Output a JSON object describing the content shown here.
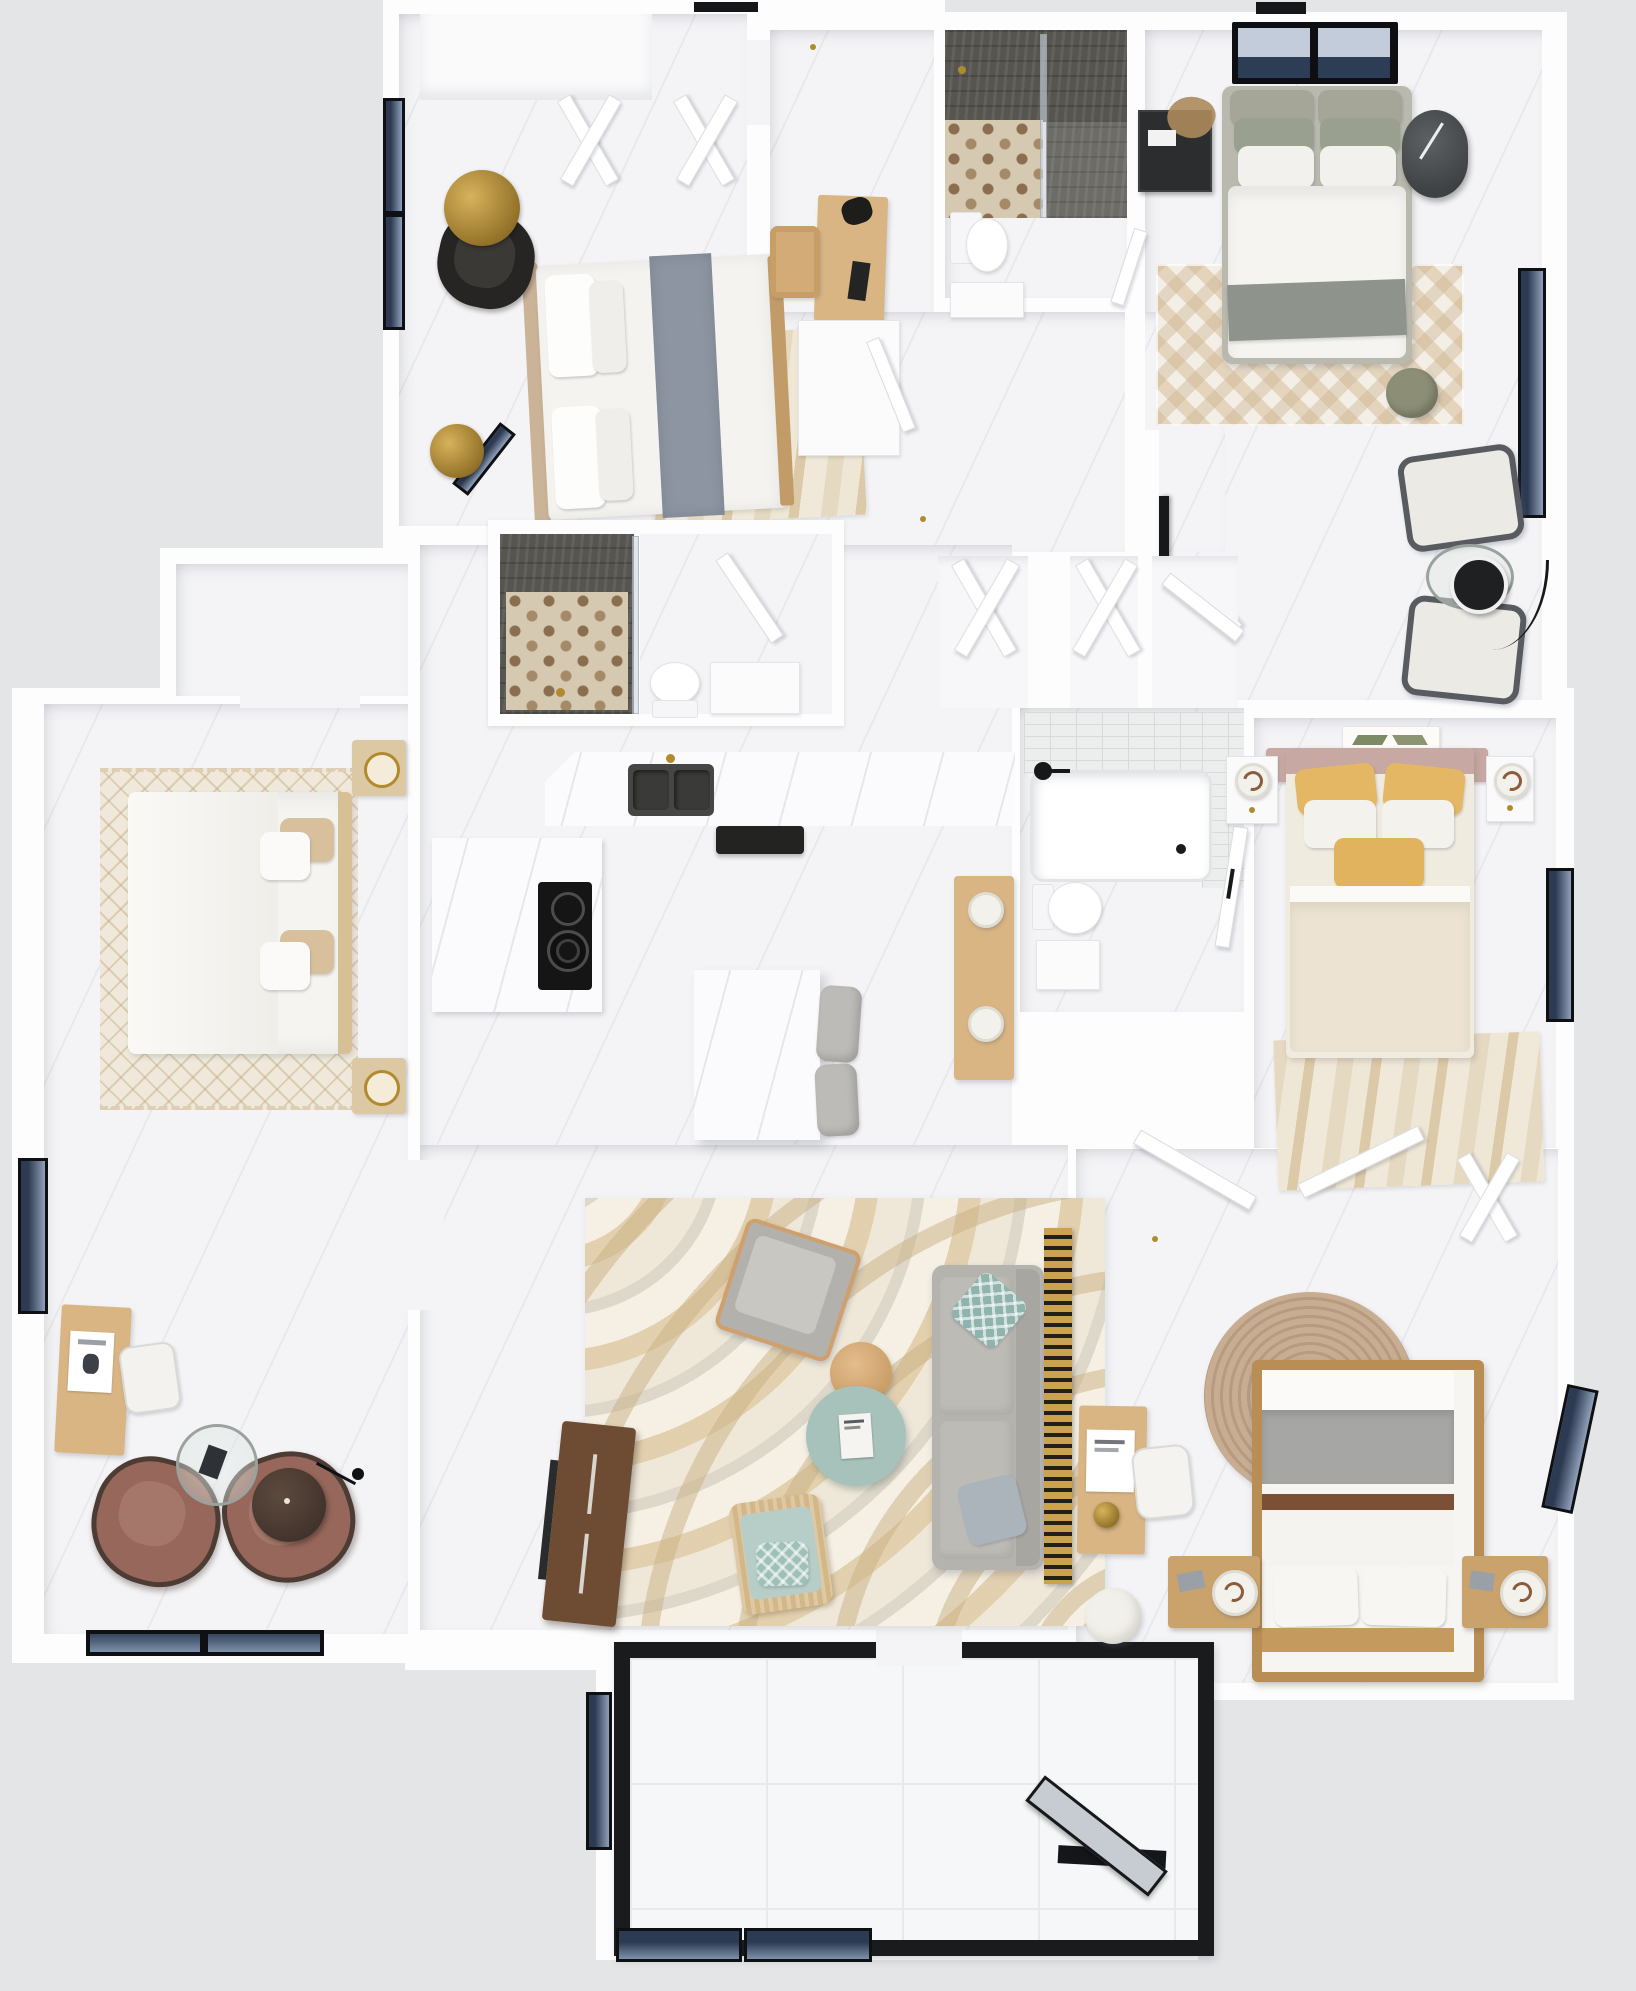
{
  "scene": {
    "title": "3D top-down floor plan rendering of a four-bedroom home",
    "view": "overhead 3D dollhouse render",
    "visible_text": ""
  },
  "palette": {
    "bg": "#e4e5e7",
    "wallWhite": "#fdfdfe",
    "floorWhite": "#f4f4f6",
    "frameBlack": "#0e1014",
    "windowNavy": "#2c3a52",
    "showerDark": "#57554f",
    "hexBase": "#d6c9b2",
    "hexDot": "#8b6e50",
    "subway": "#eceeed",
    "woodLight": "#d9b584",
    "woodMid": "#c9a36b",
    "walnut": "#6e4c33",
    "sinkDark": "#464644",
    "applianceBlack": "#232322",
    "sofaGray": "#b5b3ae",
    "teal": "#a7c2bb",
    "mustard": "#e3b763",
    "sage": "#a0a595",
    "mauve": "#c7a8a3",
    "chairBrown": "#96675a",
    "slatGold": "#cba24f",
    "rugCream": "#efe8d9",
    "jute": "#c8ad92",
    "olive": "#8c8f75",
    "brass": "#b28a2e",
    "glassBlue": "#c6ccd2"
  },
  "rooms": {
    "bedroom2": {
      "label": "Bedroom - top left",
      "items": {
        "closet": "Closet with bifold doors",
        "bed": "Double bed with slate-gray runner",
        "rug": "Wavy area rug",
        "armchair": "Black accent chair",
        "floorLamp": "Gold dome floor lamp",
        "lamp2": "Gold dome lamp",
        "windows": "Casement windows",
        "desk": "Writing desk",
        "deskChair": "Wooden desk chair",
        "deskLamp": "Black desk lamp",
        "wardrobe": "Wardrobe cabinet"
      }
    },
    "bath1": {
      "label": "Bathroom - top",
      "items": {
        "shower": "Walk-in shower with mosaic tile floor",
        "screen": "Glass shower screen",
        "showerHead": "Brass shower head",
        "toilet": "Toilet",
        "vanity": "Vanity"
      }
    },
    "bedroom1": {
      "label": "Bedroom - top right with sitting area",
      "items": {
        "windowTop": "Double window",
        "windowRight": "Window",
        "bed": "Upholstered bed with gray throw",
        "nightstand": "Black nightstand with dried plant",
        "drumTable": "Charcoal drum side table",
        "rug": "Chevron area rug",
        "pouf": "Olive round pouf",
        "tv": "Wall-mounted TV",
        "armchair1": "Lounge chair",
        "armchair2": "Lounge chair",
        "glassTable": "Round glass table",
        "blackTable": "Black round side table",
        "floorLamp": "Arc floor lamp",
        "door": "Bedroom door"
      }
    },
    "hallway": {
      "label": "Hallway",
      "items": {
        "closet1": "Bifold linen closet",
        "closet2": "Bifold linen closet",
        "door": "Closet door"
      }
    },
    "bath2": {
      "label": "Bathroom - middle",
      "items": {
        "shower": "Walk-in shower with mosaic tile floor",
        "screen": "Glass shower screen",
        "toilet": "Toilet",
        "vanity": "Vanity",
        "door": "Bathroom door"
      }
    },
    "kitchen": {
      "label": "Kitchen",
      "items": {
        "counter": "Marble countertop",
        "sink": "Double-basin sink with brass faucet",
        "appliance": "Built-in black appliance",
        "cooktop": "Radiant cooktop",
        "island": "Marble island",
        "stool1": "Counter stool",
        "stool2": "Counter stool",
        "console": "Wood console with white lamps"
      }
    },
    "master": {
      "label": "Primary bedroom",
      "items": {
        "closet": "Walk-in closet",
        "doors": "Double entry doors",
        "bed": "King bed with white duvet",
        "rug": "Diamond-weave fringed rug",
        "nightstand1": "Nightstand with brass tray",
        "nightstand2": "Nightstand with brass tray",
        "desk": "Desk with poster",
        "deskChair": "White desk chair",
        "chair1": "Rust lounge chair",
        "chair2": "Rust lounge chair",
        "coffeeTable": "Round glass cocktail table",
        "sideTable": "Walnut drum table",
        "floorLamp": "Black floor lamp",
        "windowLeft": "Window",
        "windowBottom": "Picture windows"
      }
    },
    "bath3": {
      "label": "Bathroom - with tub",
      "items": {
        "tub": "Alcove bathtub with subway tile surround",
        "faucet": "Matte-black tub filler",
        "toilet": "Toilet",
        "vanity": "Vanity",
        "door": "Bathroom door"
      }
    },
    "bedroomYellow": {
      "label": "Bedroom - right",
      "items": {
        "art": "Botanical artwork",
        "headboard": "Blush upholstered headboard",
        "bed": "Bed with mustard pillows",
        "nightstand1": "Nightstand with lamp",
        "nightstand2": "Nightstand with lamp",
        "rug": "Wavy area rug",
        "window": "Window"
      }
    },
    "living": {
      "label": "Living room",
      "items": {
        "rug": "Abstract swirl rug",
        "sofa": "Gray three-seat sofa",
        "pillow1": "Teal lattice pillow",
        "pillow2": "Blue-gray pillow",
        "armchair": "Gray armchair",
        "rattanChair": "Cane accent chair with teal cushion",
        "coffeeTable": "Round teal coffee table",
        "book": "Coffee-table book",
        "sideTable": "Round wood side table",
        "tvConsole": "Walnut media console",
        "pouf": "Ivory pouf",
        "shelf": "Slatted ladder shelf"
      }
    },
    "bedroom3": {
      "label": "Bedroom - bottom right",
      "items": {
        "doors": "Entry doors",
        "closet": "Bifold closet",
        "rug": "Round jute rug",
        "bed": "Wood-frame bed with gray blanket",
        "nightstand1": "Nightstand with globe lamp",
        "nightstand2": "Nightstand with globe lamp",
        "desk": "Desk with poster",
        "chair": "White desk chair",
        "window": "Window"
      }
    },
    "patio": {
      "label": "Sunroom / patio",
      "items": {
        "frame": "Black-framed glass enclosure",
        "floor": "Large-tile floor",
        "door": "Open glass door",
        "windowLeft": "Window",
        "windowsBottom": "Windows"
      }
    }
  }
}
